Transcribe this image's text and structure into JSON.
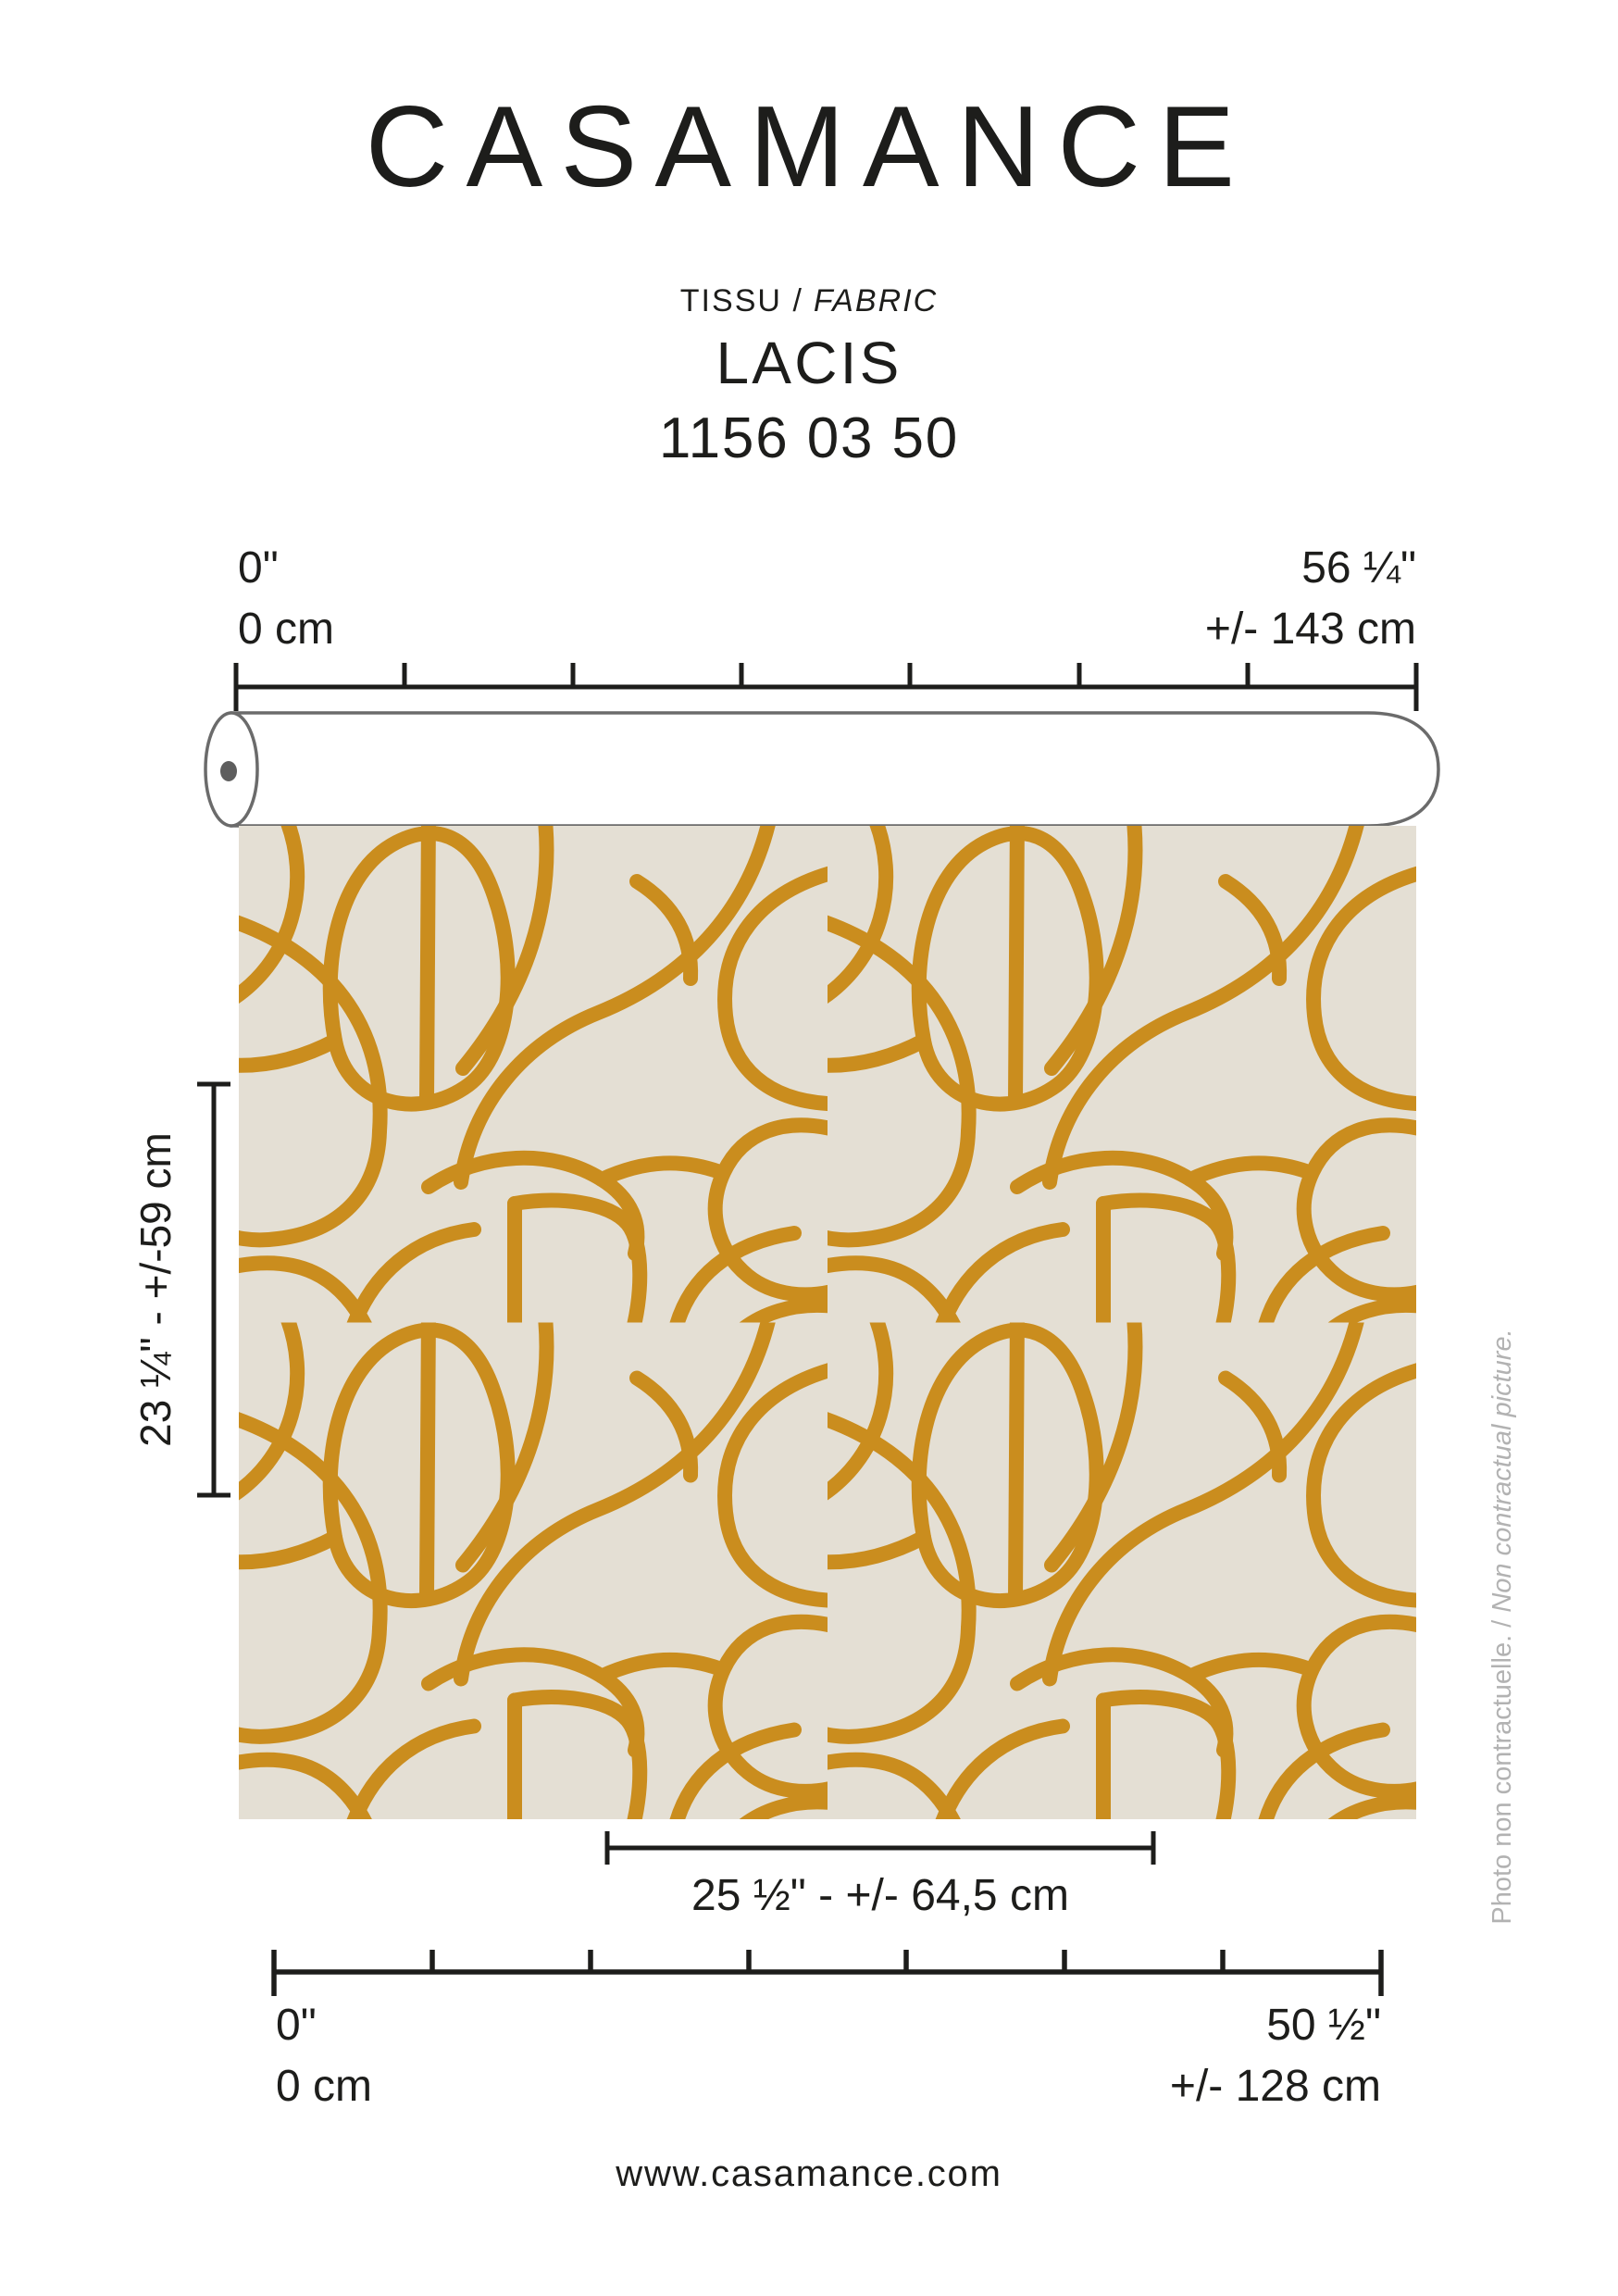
{
  "brand": {
    "logo": "CASAMANCE",
    "website": "www.casamance.com"
  },
  "product": {
    "type_fr": "TISSU /",
    "type_en": "FABRIC",
    "name": "LACIS",
    "reference": "1156 03 50"
  },
  "roll_width_scale": {
    "start_inches": "0\"",
    "start_cm": "0 cm",
    "end_inches": "56 ¼\"",
    "end_cm": "+/- 143 cm"
  },
  "usable_width_scale": {
    "start_inches": "0\"",
    "start_cm": "0 cm",
    "end_inches": "50 ½\"",
    "end_cm": "+/- 128 cm"
  },
  "vertical_repeat_label": "23 ¼\" - +/-59 cm",
  "horizontal_repeat_label": "25 ½\" - +/- 64,5 cm",
  "disclaimer": {
    "fr": "Photo non contractuelle. /",
    "en": "Non contractual picture."
  },
  "colors": {
    "ink": "#1d1d1b",
    "pattern_gold": "#ca8d1e",
    "fabric_background": "#e4dfd4",
    "roll_outline": "#6b6b6b",
    "roll_core_dot": "#5e5e5e",
    "disclaimer_gray": "#b2b2b2"
  }
}
